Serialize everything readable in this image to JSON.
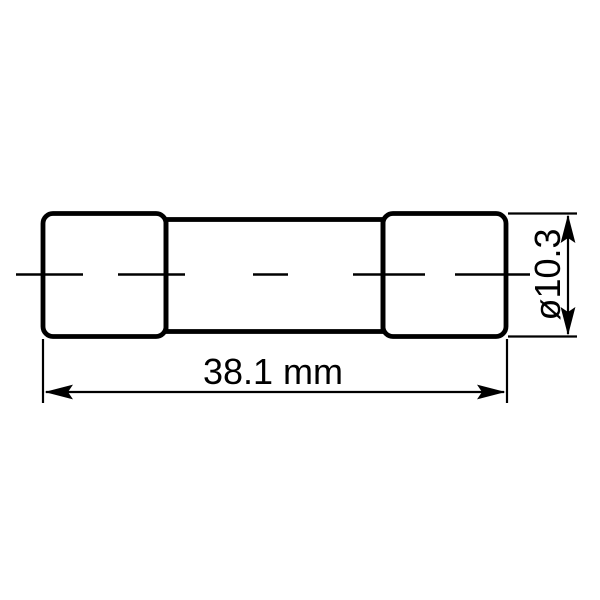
{
  "drawing": {
    "kind": "fuse-dimensional-drawing",
    "colors": {
      "line": "#000000",
      "background": "#ffffff"
    },
    "dimensions": {
      "length": {
        "label": "38.1 mm",
        "value_mm": 38.1
      },
      "diameter": {
        "label": "ø10.3",
        "value_mm": 10.3
      }
    }
  }
}
